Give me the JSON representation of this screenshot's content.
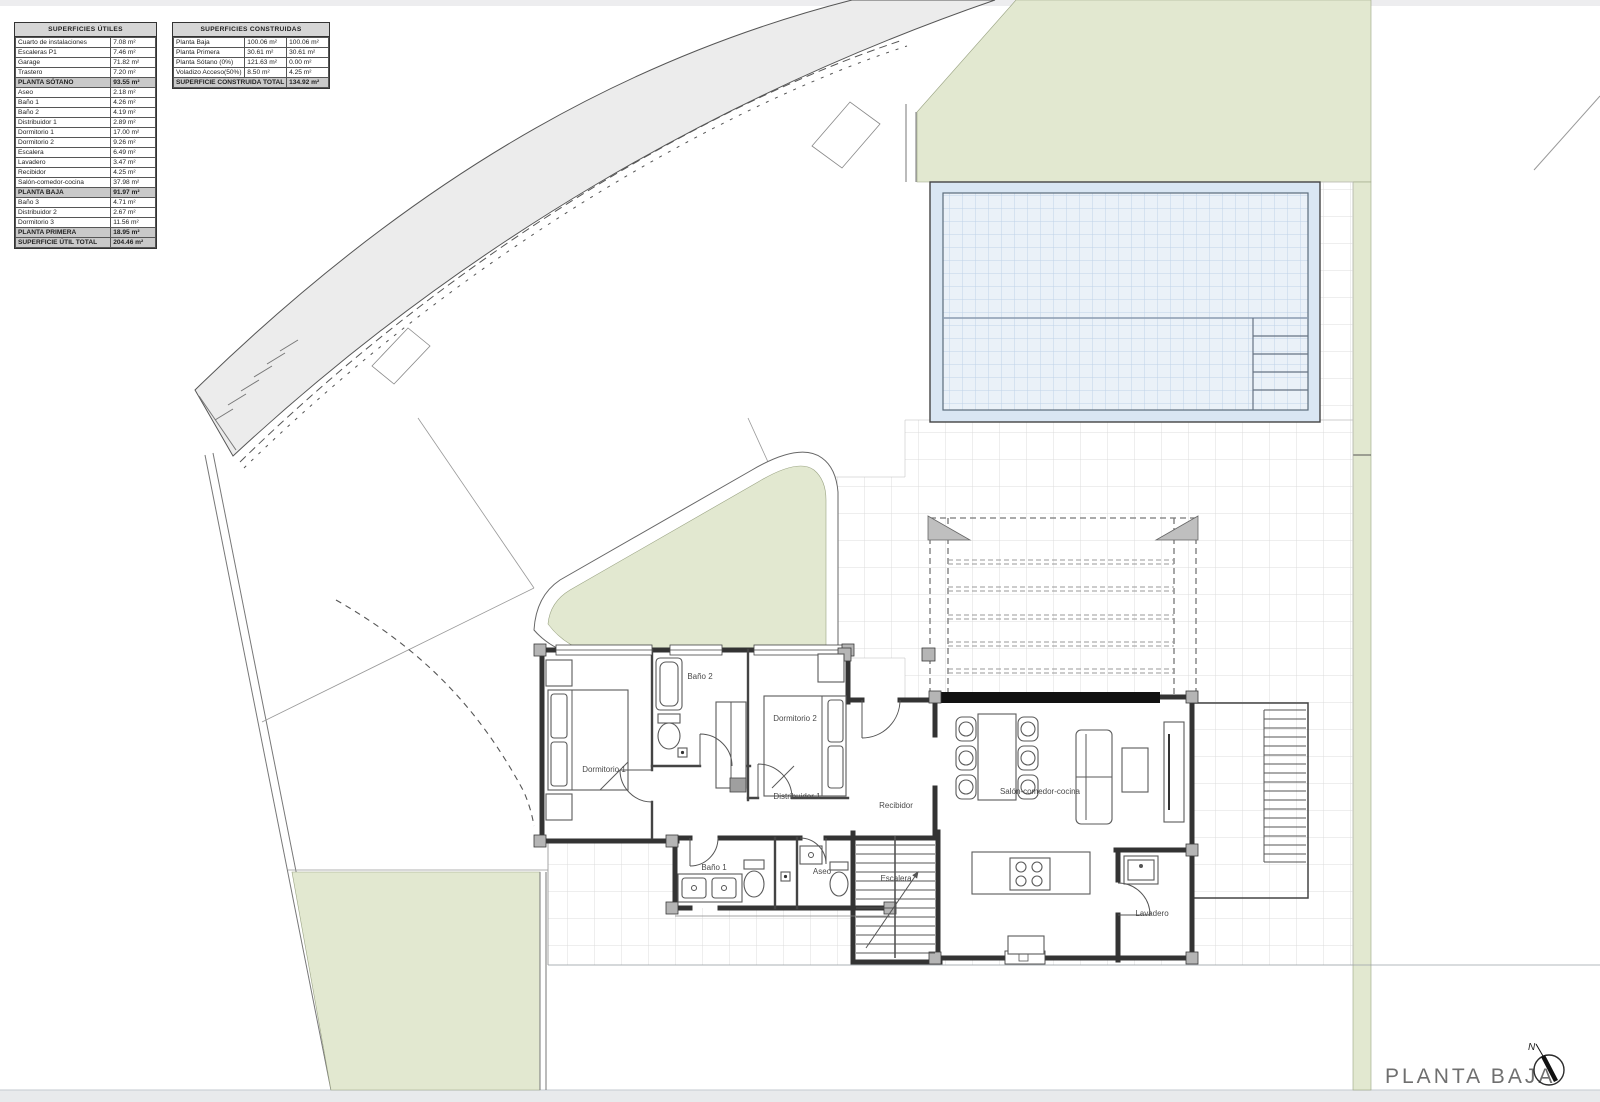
{
  "tables": {
    "utiles": {
      "title": "SUPERFICIES ÚTILES",
      "rows": [
        {
          "label": "Cuarto de instalaciones",
          "value": "7.08 m²",
          "type": "normal"
        },
        {
          "label": "Escaleras P1",
          "value": "7.46 m²",
          "type": "normal"
        },
        {
          "label": "Garage",
          "value": "71.82 m²",
          "type": "normal"
        },
        {
          "label": "Trastero",
          "value": "7.20 m²",
          "type": "normal"
        },
        {
          "label": "PLANTA SÓTANO",
          "value": "93.55 m²",
          "type": "subtotal"
        },
        {
          "label": "Aseo",
          "value": "2.18 m²",
          "type": "normal"
        },
        {
          "label": "Baño 1",
          "value": "4.26 m²",
          "type": "normal"
        },
        {
          "label": "Baño 2",
          "value": "4.19 m²",
          "type": "normal"
        },
        {
          "label": "Distribuidor 1",
          "value": "2.89 m²",
          "type": "normal"
        },
        {
          "label": "Dormitorio 1",
          "value": "17.00 m²",
          "type": "normal"
        },
        {
          "label": "Dormitorio 2",
          "value": "9.26 m²",
          "type": "normal"
        },
        {
          "label": "Escalera",
          "value": "6.49 m²",
          "type": "normal"
        },
        {
          "label": "Lavadero",
          "value": "3.47 m²",
          "type": "normal"
        },
        {
          "label": "Recibidor",
          "value": "4.25 m²",
          "type": "normal"
        },
        {
          "label": "Salón-comedor-cocina",
          "value": "37.98 m²",
          "type": "normal"
        },
        {
          "label": "PLANTA BAJA",
          "value": "91.97 m²",
          "type": "subtotal"
        },
        {
          "label": "Baño 3",
          "value": "4.71 m²",
          "type": "normal"
        },
        {
          "label": "Distribuidor 2",
          "value": "2.67 m²",
          "type": "normal"
        },
        {
          "label": "Dormitorio 3",
          "value": "11.56 m²",
          "type": "normal"
        },
        {
          "label": "PLANTA PRIMERA",
          "value": "18.95 m²",
          "type": "subtotal"
        },
        {
          "label": "SUPERFICIE ÚTIL TOTAL",
          "value": "204.46 m²",
          "type": "total"
        }
      ]
    },
    "construidas": {
      "title": "SUPERFICIES CONSTRUIDAS",
      "rows": [
        {
          "label": "Planta Baja",
          "value1": "100.06 m²",
          "value2": "100.06 m²"
        },
        {
          "label": "Planta Primera",
          "value1": "30.61 m²",
          "value2": "30.61 m²"
        },
        {
          "label": "Planta Sótano (0%)",
          "value1": "121.63 m²",
          "value2": "0.00 m²"
        },
        {
          "label": "Voladizo Acceso(50%)",
          "value1": "8.50 m²",
          "value2": "4.25 m²"
        }
      ],
      "total_label": "SUPERFICIE CONSTRUIDA TOTAL",
      "total_value": "134.92 m²"
    }
  },
  "plan": {
    "title": "PLANTA BAJA",
    "north_label": "N",
    "rooms": [
      {
        "label": "Dormitorio 1"
      },
      {
        "label": "Baño 2"
      },
      {
        "label": "Dormitorio 2"
      },
      {
        "label": "Distribuidor 1"
      },
      {
        "label": "Recibidor"
      },
      {
        "label": "Baño 1"
      },
      {
        "label": "Aseo"
      },
      {
        "label": "Escalera"
      },
      {
        "label": "Salón-comedor-cocina"
      },
      {
        "label": "Lavadero"
      }
    ]
  },
  "colors": {
    "green": "#e2e8d0",
    "road": "#ececec",
    "pool_deck": "#d9e6f3",
    "pool_water": "#eaf1f8",
    "pool_grid": "#c0d3e8",
    "tile": "#dcdcdc",
    "wall": "#333333",
    "joint": "#b5b5b5",
    "label": "#4a4a4a",
    "title": "#6f6f6f",
    "row_header": "#d6d6d6",
    "row_subtotal": "#c9c9c9"
  }
}
